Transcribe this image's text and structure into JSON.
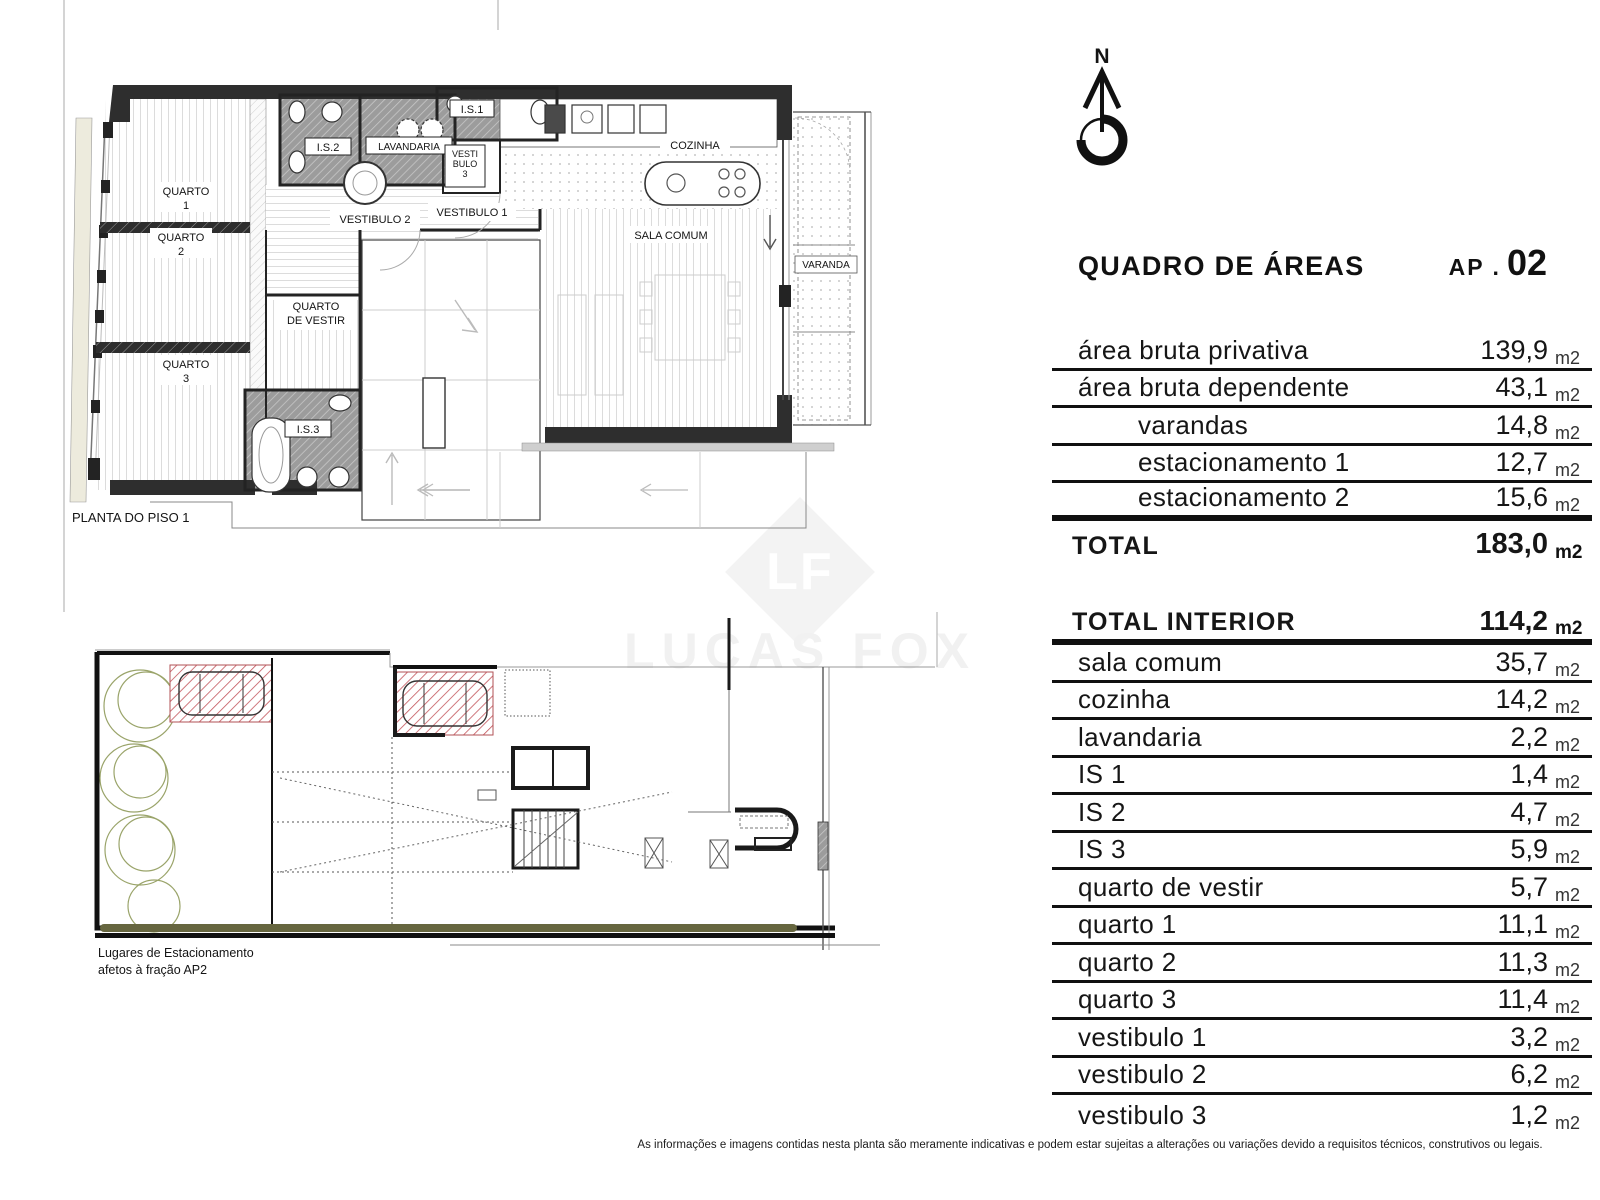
{
  "north": {
    "letter": "N"
  },
  "watermark": {
    "initials": "LF",
    "name": "LUCAS FOX"
  },
  "plan1": {
    "caption": "PLANTA DO PISO 1",
    "rooms": {
      "q1a": "QUARTO",
      "q1b": "1",
      "q2a": "QUARTO",
      "q2b": "2",
      "q3a": "QUARTO",
      "q3b": "3",
      "is1": "I.S.1",
      "is2": "I.S.2",
      "is3": "I.S.3",
      "lav": "LAVANDARIA",
      "v3a": "VESTI",
      "v3b": "BULO",
      "v3c": "3",
      "v1": "VESTIBULO 1",
      "v2": "VESTIBULO 2",
      "qva": "QUARTO",
      "qvb": "DE VESTIR",
      "coz": "COZINHA",
      "sala": "SALA COMUM",
      "var": "VARANDA"
    }
  },
  "plan2": {
    "caption_line1": "Lugares de Estacionamento",
    "caption_line2": "afetos à fração  AP2"
  },
  "areas": {
    "title": "QUADRO DE ÁREAS",
    "ap_prefix": "AP .",
    "ap_number": "02",
    "table1": [
      {
        "label": "área bruta privativa",
        "value": "139,9",
        "unit": "m2"
      },
      {
        "label": "área bruta dependente",
        "value": "43,1",
        "unit": "m2"
      },
      {
        "label": "varandas",
        "value": "14,8",
        "unit": "m2"
      },
      {
        "label": "estacionamento 1",
        "value": "12,7",
        "unit": "m2"
      },
      {
        "label": "estacionamento 2",
        "value": "15,6",
        "unit": "m2"
      }
    ],
    "total": {
      "label": "TOTAL",
      "value": "183,0",
      "unit": "m2"
    },
    "interior_header": {
      "label": "TOTAL INTERIOR",
      "value": "114,2",
      "unit": "m2"
    },
    "table2": [
      {
        "label": "sala comum",
        "value": "35,7",
        "unit": "m2"
      },
      {
        "label": "cozinha",
        "value": "14,2",
        "unit": "m2"
      },
      {
        "label": "lavandaria",
        "value": "2,2",
        "unit": "m2"
      },
      {
        "label": "IS 1",
        "value": "1,4",
        "unit": "m2"
      },
      {
        "label": "IS 2",
        "value": "4,7",
        "unit": "m2"
      },
      {
        "label": "IS 3",
        "value": "5,9",
        "unit": "m2"
      },
      {
        "label": "quarto de vestir",
        "value": "5,7",
        "unit": "m2"
      },
      {
        "label": "quarto 1",
        "value": "11,1",
        "unit": "m2"
      },
      {
        "label": "quarto 2",
        "value": "11,3",
        "unit": "m2"
      },
      {
        "label": "quarto 3",
        "value": "11,4",
        "unit": "m2"
      },
      {
        "label": "vestibulo 1",
        "value": "3,2",
        "unit": "m2"
      },
      {
        "label": "vestibulo 2",
        "value": "6,2",
        "unit": "m2"
      },
      {
        "label": "vestibulo 3",
        "value": "1,2",
        "unit": "m2"
      }
    ]
  },
  "footer": "As informações e imagens contidas nesta planta são meramente indicativas e podem estar sujeitas a alterações ou variações devido a requisitos técnicos, construtivos ou legais."
}
